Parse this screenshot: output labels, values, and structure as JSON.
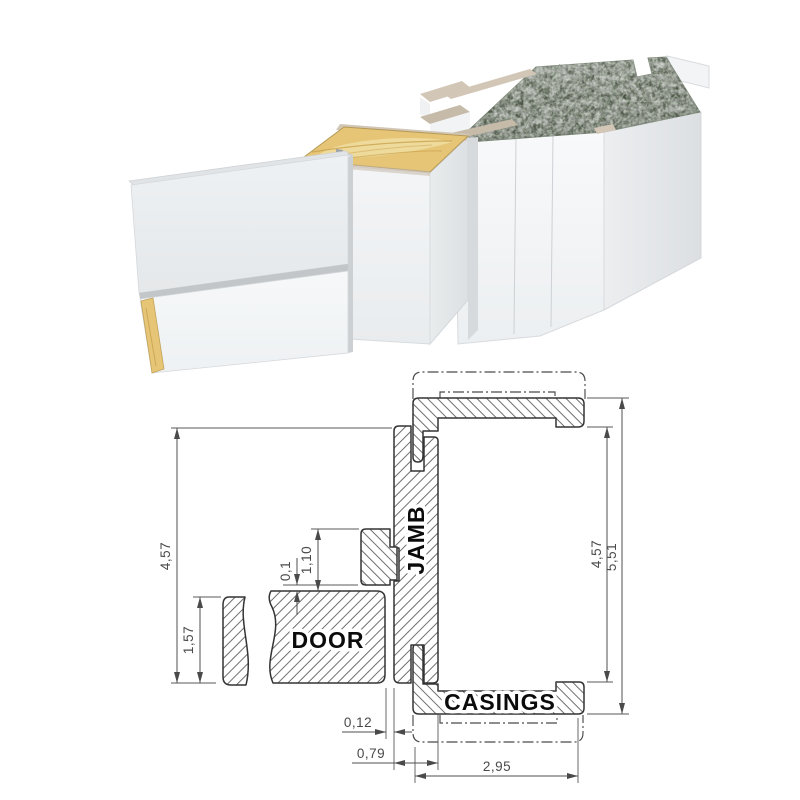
{
  "labels": {
    "door": "DOOR",
    "jamb": "JAMB",
    "casings": "CASINGS"
  },
  "dimensions": {
    "left_total": "4,57",
    "door_thickness": "1,57",
    "door_top_gap": "0,1",
    "stop_offset": "1,10",
    "door_jamb_gap": "0,12",
    "jamb_depth": "0,79",
    "casing_width": "2,95",
    "right_inner": "4,57",
    "right_total": "5,51"
  },
  "colors": {
    "marble": "#94a28d",
    "wood": "#e6c577",
    "wood_pale": "#f2e5ae",
    "trim": "#d2c6b6",
    "trim_dark": "#c6baa9",
    "white_face": "#f2f4f6",
    "line": "#343434",
    "dim": "#4a4a4a"
  }
}
